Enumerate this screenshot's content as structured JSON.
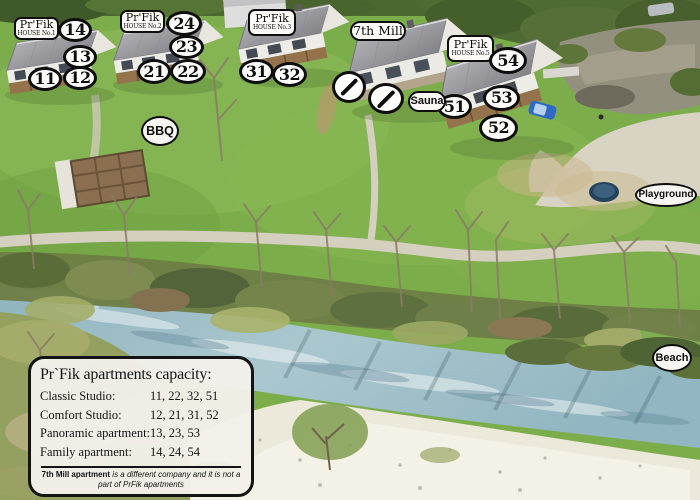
{
  "houses": [
    {
      "brand": "Pr'Fik",
      "number": "HOUSE No.1"
    },
    {
      "brand": "Pr'Fik",
      "number": "HOUSE No.2"
    },
    {
      "brand": "Pr'Fik",
      "number": "HOUSE No.3"
    },
    {
      "brand": "Pr'Fik",
      "number": "HOUSE No.5"
    }
  ],
  "mill_house_label": "7th Mill",
  "unit_badges": [
    "14",
    "13",
    "11",
    "12",
    "24",
    "23",
    "21",
    "22",
    "31",
    "32",
    "54",
    "53",
    "52",
    "51"
  ],
  "amenities": {
    "bbq": "BBQ",
    "sauna": "Sauna",
    "playground": "Playground",
    "beach": "Beach"
  },
  "capacity_box": {
    "title": "Pr`Fik apartments capacity:",
    "rows": [
      {
        "label": "Classic Studio:",
        "units": "11, 22, 32, 51"
      },
      {
        "label": "Comfort Studio:",
        "units": "12, 21, 31, 52"
      },
      {
        "label": "Panoramic apartment:",
        "units": "13, 23, 53"
      },
      {
        "label": "Family apartment:",
        "units": "14, 24, 54"
      }
    ],
    "note_bold": "7th Mill apartment",
    "note_rest": " is a different company and it is not a part of PrFik apartments"
  },
  "colors": {
    "label_border": "#0e0e0e",
    "label_background": "#fbfaf6",
    "grass": "#7cad4b",
    "river": "#9dbcc4",
    "gravel_beach": "#ece8da",
    "roof": "#9a9a9e"
  }
}
